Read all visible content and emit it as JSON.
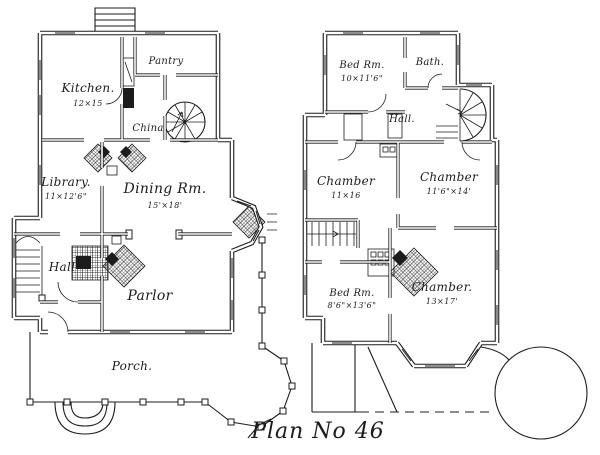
{
  "page": {
    "background": "#ffffff",
    "ink": "#1c1c1c"
  },
  "title": {
    "text": "Plan No 46"
  },
  "first_floor": {
    "rooms": {
      "kitchen": {
        "name": "Kitchen.",
        "dims": "12×15"
      },
      "pantry": {
        "name": "Pantry"
      },
      "china": {
        "name": "China"
      },
      "library": {
        "name": "Library.",
        "dims": "11×12'6\""
      },
      "dining": {
        "name": "Dining Rm.",
        "dims": "15'×18'"
      },
      "hall": {
        "name": "Hall"
      },
      "parlor": {
        "name": "Parlor"
      },
      "porch": {
        "name": "Porch."
      }
    }
  },
  "second_floor": {
    "rooms": {
      "bedroom_front": {
        "name": "Bed Rm.",
        "dims": "10×11'6\""
      },
      "bath": {
        "name": "Bath."
      },
      "hall": {
        "name": "Hall."
      },
      "chamber_left": {
        "name": "Chamber",
        "dims": "11×16"
      },
      "chamber_right": {
        "name": "Chamber",
        "dims": "11'6\"×14'"
      },
      "bedroom_back": {
        "name": "Bed Rm.",
        "dims": "8'6\"×13'6\""
      },
      "chamber_rear": {
        "name": "Chamber.",
        "dims": "13×17'"
      }
    }
  }
}
